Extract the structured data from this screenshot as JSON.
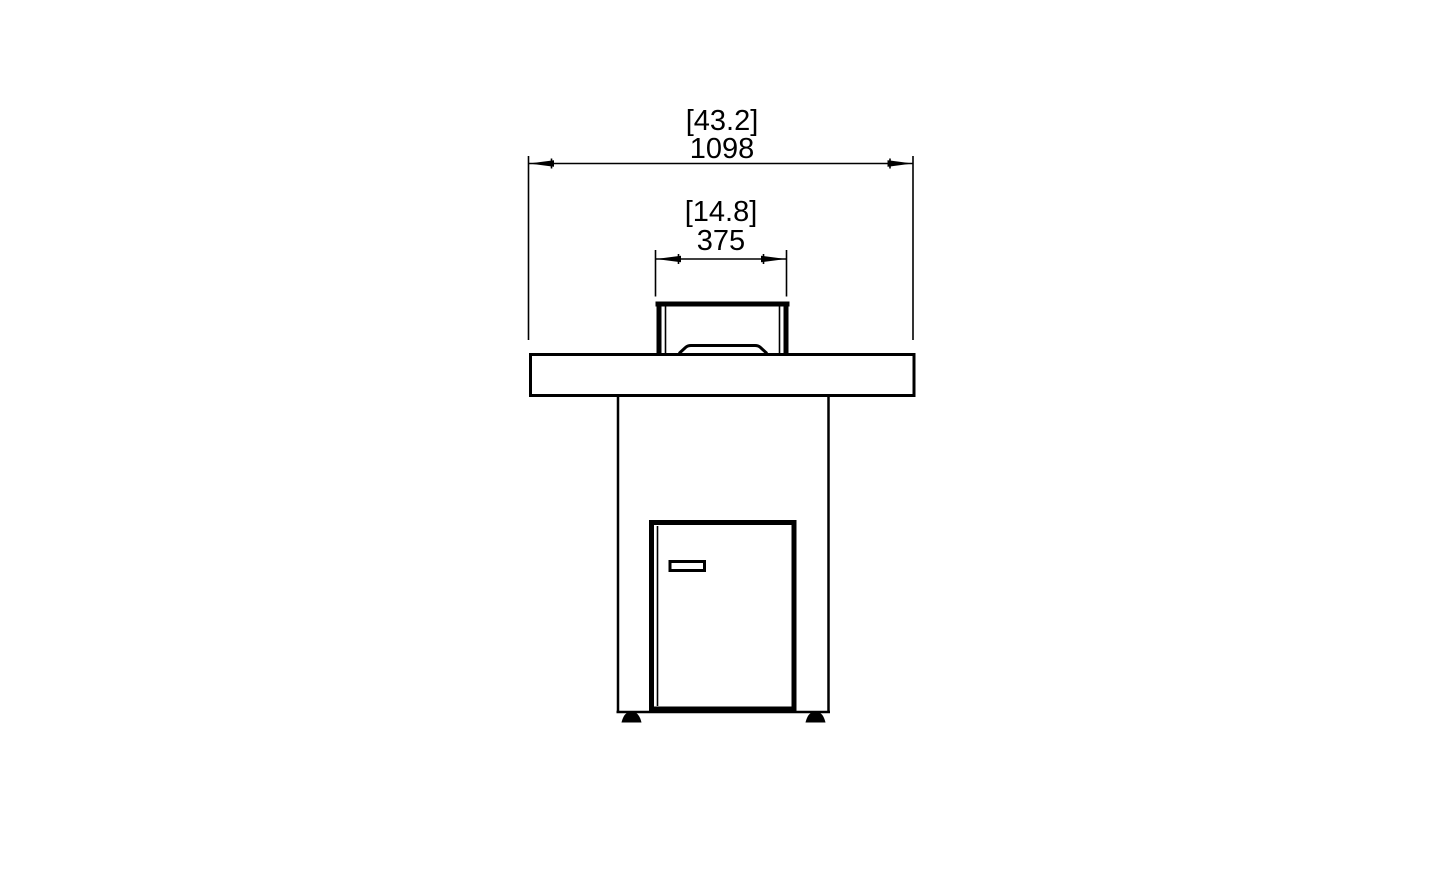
{
  "page": {
    "background_color": "#ffffff",
    "line_color": "#000000"
  },
  "dimensions": {
    "overall_width": {
      "imperial_in": "[43.2]",
      "metric_mm": "1098"
    },
    "burner_width": {
      "imperial_in": "[14.8]",
      "metric_mm": "375"
    }
  }
}
